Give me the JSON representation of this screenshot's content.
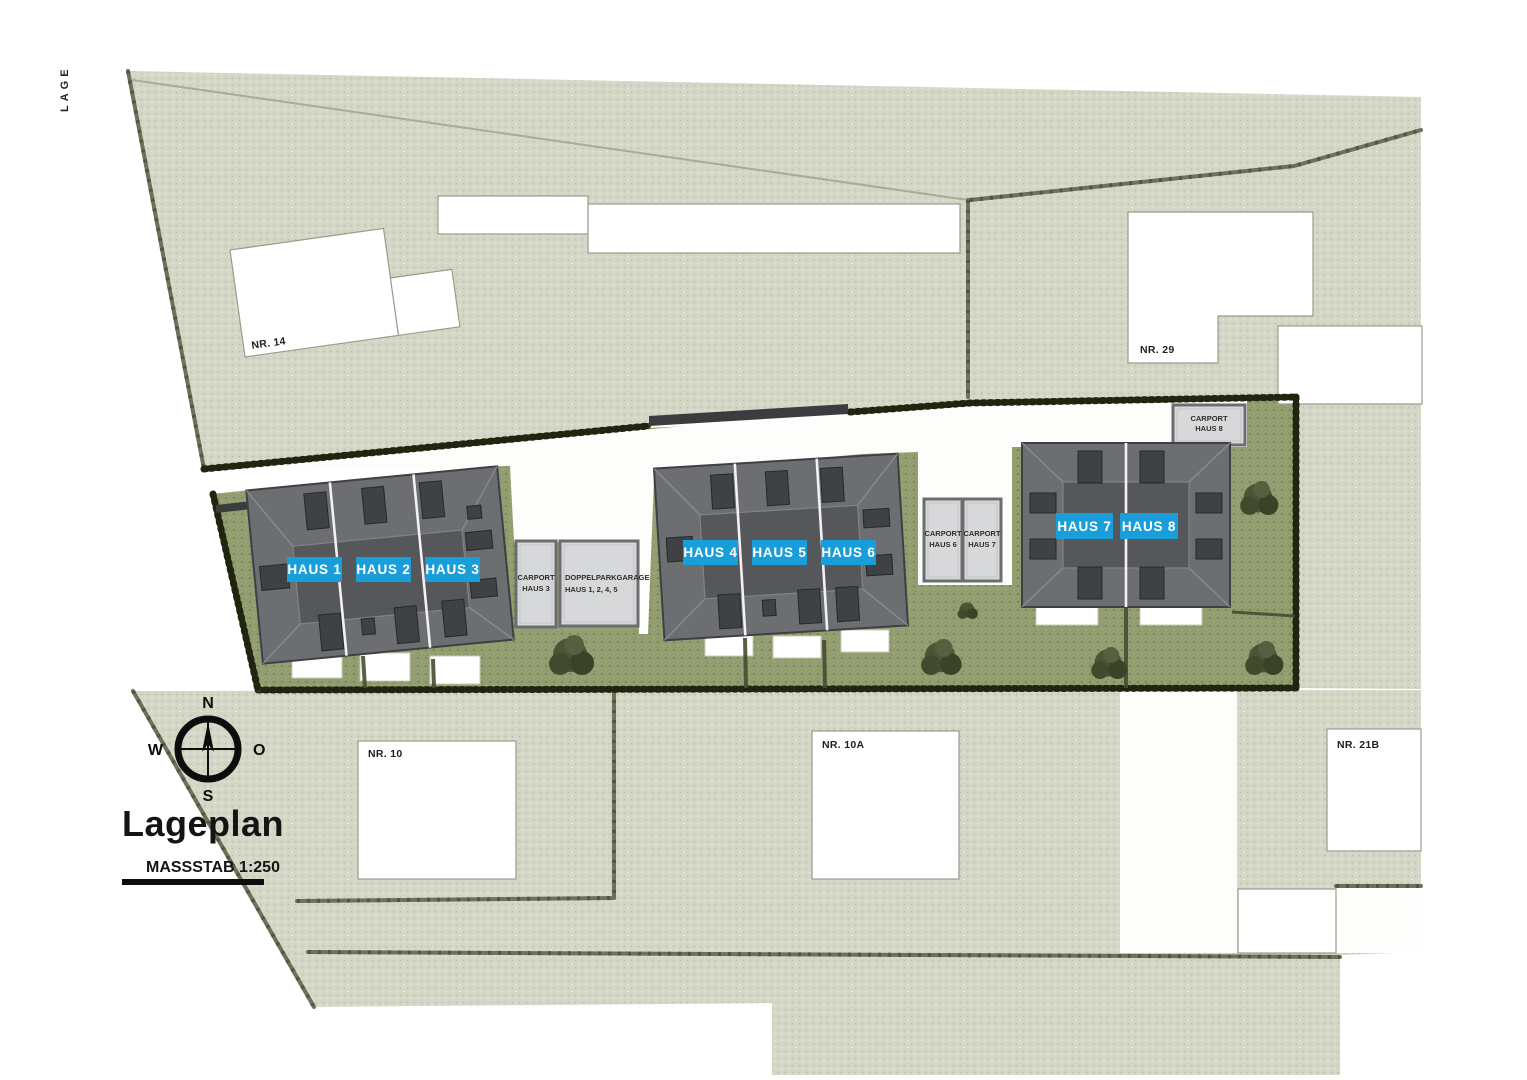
{
  "page": {
    "side_label": "LAGE"
  },
  "legend": {
    "title": "Lageplan",
    "scale": "MASSSTAB 1:250"
  },
  "compass": {
    "north": "N",
    "east": "O",
    "south": "S",
    "west": "W"
  },
  "houses": [
    {
      "label": "HAUS 1"
    },
    {
      "label": "HAUS 2"
    },
    {
      "label": "HAUS 3"
    },
    {
      "label": "HAUS 4"
    },
    {
      "label": "HAUS 5"
    },
    {
      "label": "HAUS 6"
    },
    {
      "label": "HAUS 7"
    },
    {
      "label": "HAUS 8"
    }
  ],
  "outbuildings": {
    "carport3": {
      "line1": "CARPORT",
      "line2": "HAUS 3"
    },
    "garage": {
      "line1": "DOPPELPARKGARAGE",
      "line2": "HAUS 1, 2, 4, 5"
    },
    "carport6": {
      "line1": "CARPORT",
      "line2": "HAUS 6"
    },
    "carport7": {
      "line1": "CARPORT",
      "line2": "HAUS 7"
    },
    "carport8": {
      "line1": "CARPORT",
      "line2": "HAUS 8"
    }
  },
  "neighbors": {
    "nr14": "NR. 14",
    "nr29": "NR. 29",
    "nr10": "NR. 10",
    "nr10a": "NR. 10A",
    "nr21b": "NR. 21B"
  },
  "colors": {
    "accent_blue": "#1a9ed9",
    "roof": "#6c6e71",
    "roof_inner": "#55575a",
    "lawn_green": "#929e70",
    "parcel_sage": "#d4d6c6",
    "hedge_dark": "#343a20"
  }
}
